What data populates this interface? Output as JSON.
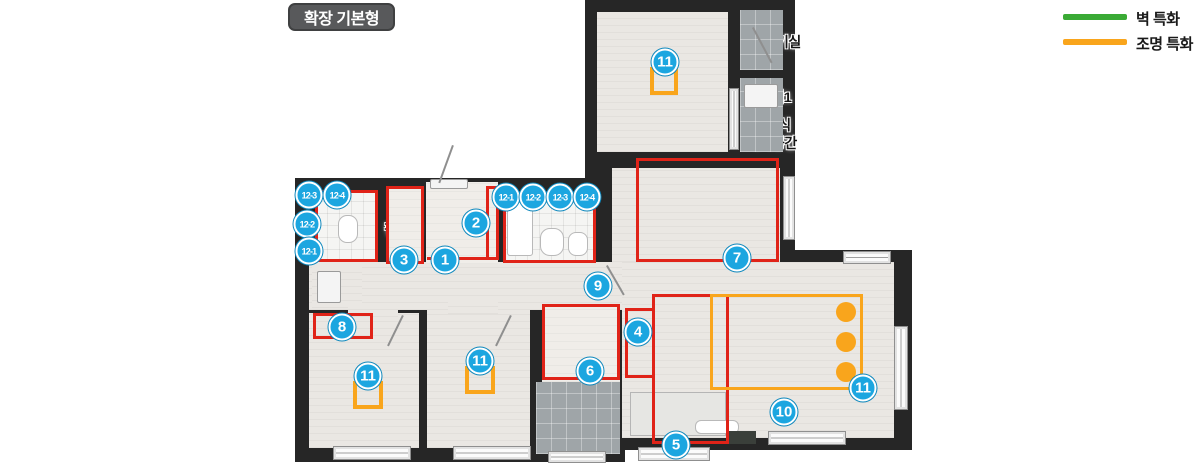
{
  "title": "확장 기본형",
  "legend": {
    "wall": {
      "label": "벽 특화",
      "color": "#3aaa35"
    },
    "light": {
      "label": "조명 특화",
      "color": "#f9a51c"
    }
  },
  "rooms": {
    "bedroom1": "침실1",
    "outdoor_unit": "실외기실",
    "balcony1": "발코니1",
    "escape_line1": "하향식",
    "escape_line2": "대피공간",
    "bath1": "욕실1",
    "entry_pantry_line1": "현관",
    "entry_pantry_line2": "팬트리",
    "entry": "현관",
    "bath2": "욕실2",
    "dressroom": "드레스룸",
    "alpharoom": "알파룸",
    "hall_pantry_line1": "복도",
    "hall_pantry_line2": "팬트리",
    "kitchen": "주방/식당",
    "living": "거실",
    "bedroom2": "침실2",
    "bedroom3": "침실3",
    "balcony2": "발코니2"
  },
  "markers": {
    "n1": "1",
    "n2": "2",
    "n3": "3",
    "n4": "4",
    "n5": "5",
    "n6": "6",
    "n7": "7",
    "n8": "8",
    "n9": "9",
    "n10": "10",
    "n11": "11",
    "s1": "12-1",
    "s2": "12-2",
    "s3": "12-3",
    "s4": "12-4"
  },
  "colors": {
    "wall": "#262626",
    "floor": "#eae7e3",
    "red_zone": "#e02318",
    "light_zone": "#f9a51c",
    "marker_blue": "#1ca6e0"
  }
}
